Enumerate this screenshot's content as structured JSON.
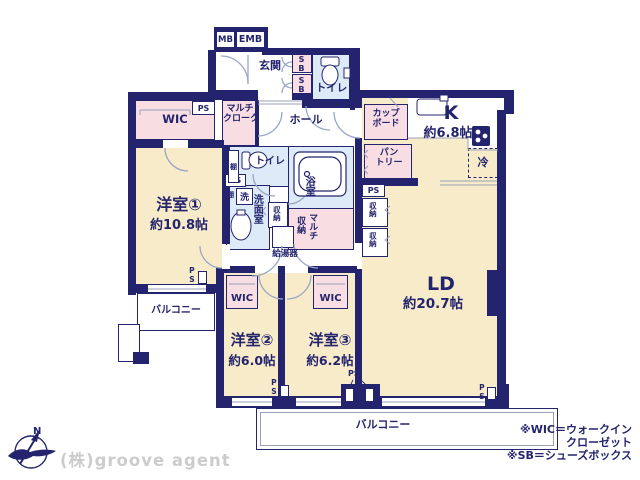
{
  "colors": {
    "wall": "#24246e",
    "room": "#f7ebc9",
    "closet": "#f8dde2",
    "wet": "#dcebf7",
    "arc": "#9aa6c6",
    "watermark": "#cccccc"
  },
  "meter_box": {
    "mb": "MB",
    "emb": "EMB"
  },
  "entrance": {
    "label": "玄関",
    "shoe_box": "SB"
  },
  "hall": {
    "label": "ホール"
  },
  "toilet": {
    "label": "トイレ"
  },
  "bath": {
    "label": "浴室"
  },
  "washroom": {
    "label": "洗面室",
    "laundry": "洗",
    "shelf": "棚"
  },
  "storage": {
    "wic": "WIC",
    "multi_cloak_l1": "マルチ",
    "multi_cloak_l2": "クローク",
    "multi_storage_right": "マルチ",
    "multi_storage_left": "収納",
    "closet": "収納",
    "pipe_space": "PS",
    "water_heater": "給湯器"
  },
  "kitchen": {
    "label": "K",
    "size": "約6.8帖",
    "cupboard_l1": "カップ",
    "cupboard_l2": "ボード",
    "pantry_l1": "パン",
    "pantry_l2": "トリー",
    "fridge": "冷"
  },
  "living": {
    "label": "LD",
    "size": "約20.7帖"
  },
  "bedrooms": [
    {
      "name": "洋室①",
      "size": "約10.8帖"
    },
    {
      "name": "洋室②",
      "size": "約6.0帖"
    },
    {
      "name": "洋室③",
      "size": "約6.2帖"
    }
  ],
  "balcony": {
    "label": "バルコニー"
  },
  "compass": {
    "north": "N"
  },
  "notes": [
    "※WIC＝ウォークイン",
    "クローゼット",
    "※SB＝シューズボックス"
  ],
  "watermark": "(株)groove agent"
}
